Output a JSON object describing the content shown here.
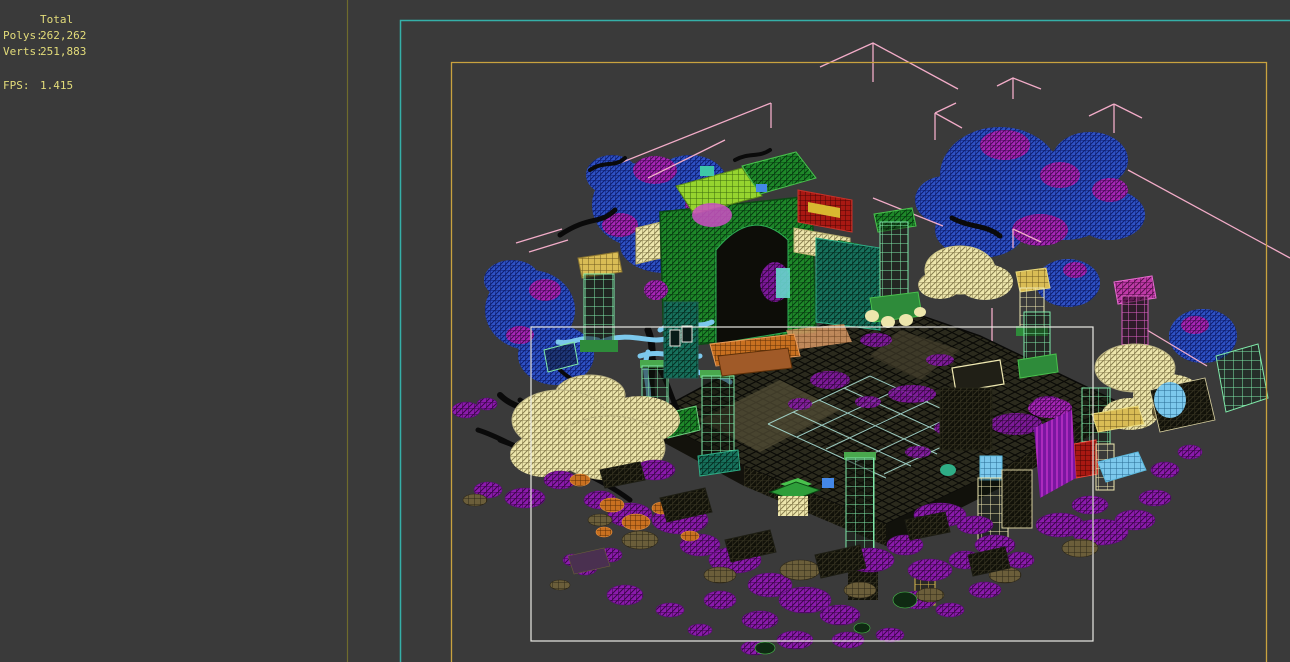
{
  "window": {
    "width": 1290,
    "height": 662,
    "background": "#3A3A3A"
  },
  "stats_panel": {
    "total_label": "Total",
    "polys_label": "Polys:",
    "polys_value": "262,262",
    "verts_label": "Verts:",
    "verts_value": "251,883",
    "fps_label": "FPS:",
    "fps_value": "1.415",
    "text_color": "#E3DC7A"
  },
  "viewport": {
    "colors": {
      "active_border": "#35AFA8",
      "safe_frame": "#C9A23F",
      "selection_region": "#E9E9E3",
      "group_bracket": "#F2ACC8",
      "panel_divider": "#6F6B2D"
    },
    "scene_palette": {
      "foliage_blue": "#2F52C6",
      "foliage_magenta": "#A626B6",
      "rock_purple": "#8B1AAC",
      "rock_orange": "#C87020",
      "rock_olive": "#6B5E3A",
      "structure_green": "#1E8829",
      "roof_lime": "#96D42F",
      "lattice_mint": "#7FE9A9",
      "lattice_cream": "#EFE8B0",
      "accent_khaki": "#D9BC55",
      "accent_teal": "#1E8A66",
      "accent_cyan": "#7CC8EC",
      "accent_salmon": "#D99A66",
      "sign_red": "#8E1412",
      "tower_pink": "#D042B8",
      "platform_dark": "#2B2A1D",
      "grid_cyan": "#A8DCD2",
      "wire_black": "#0C0C08"
    }
  }
}
